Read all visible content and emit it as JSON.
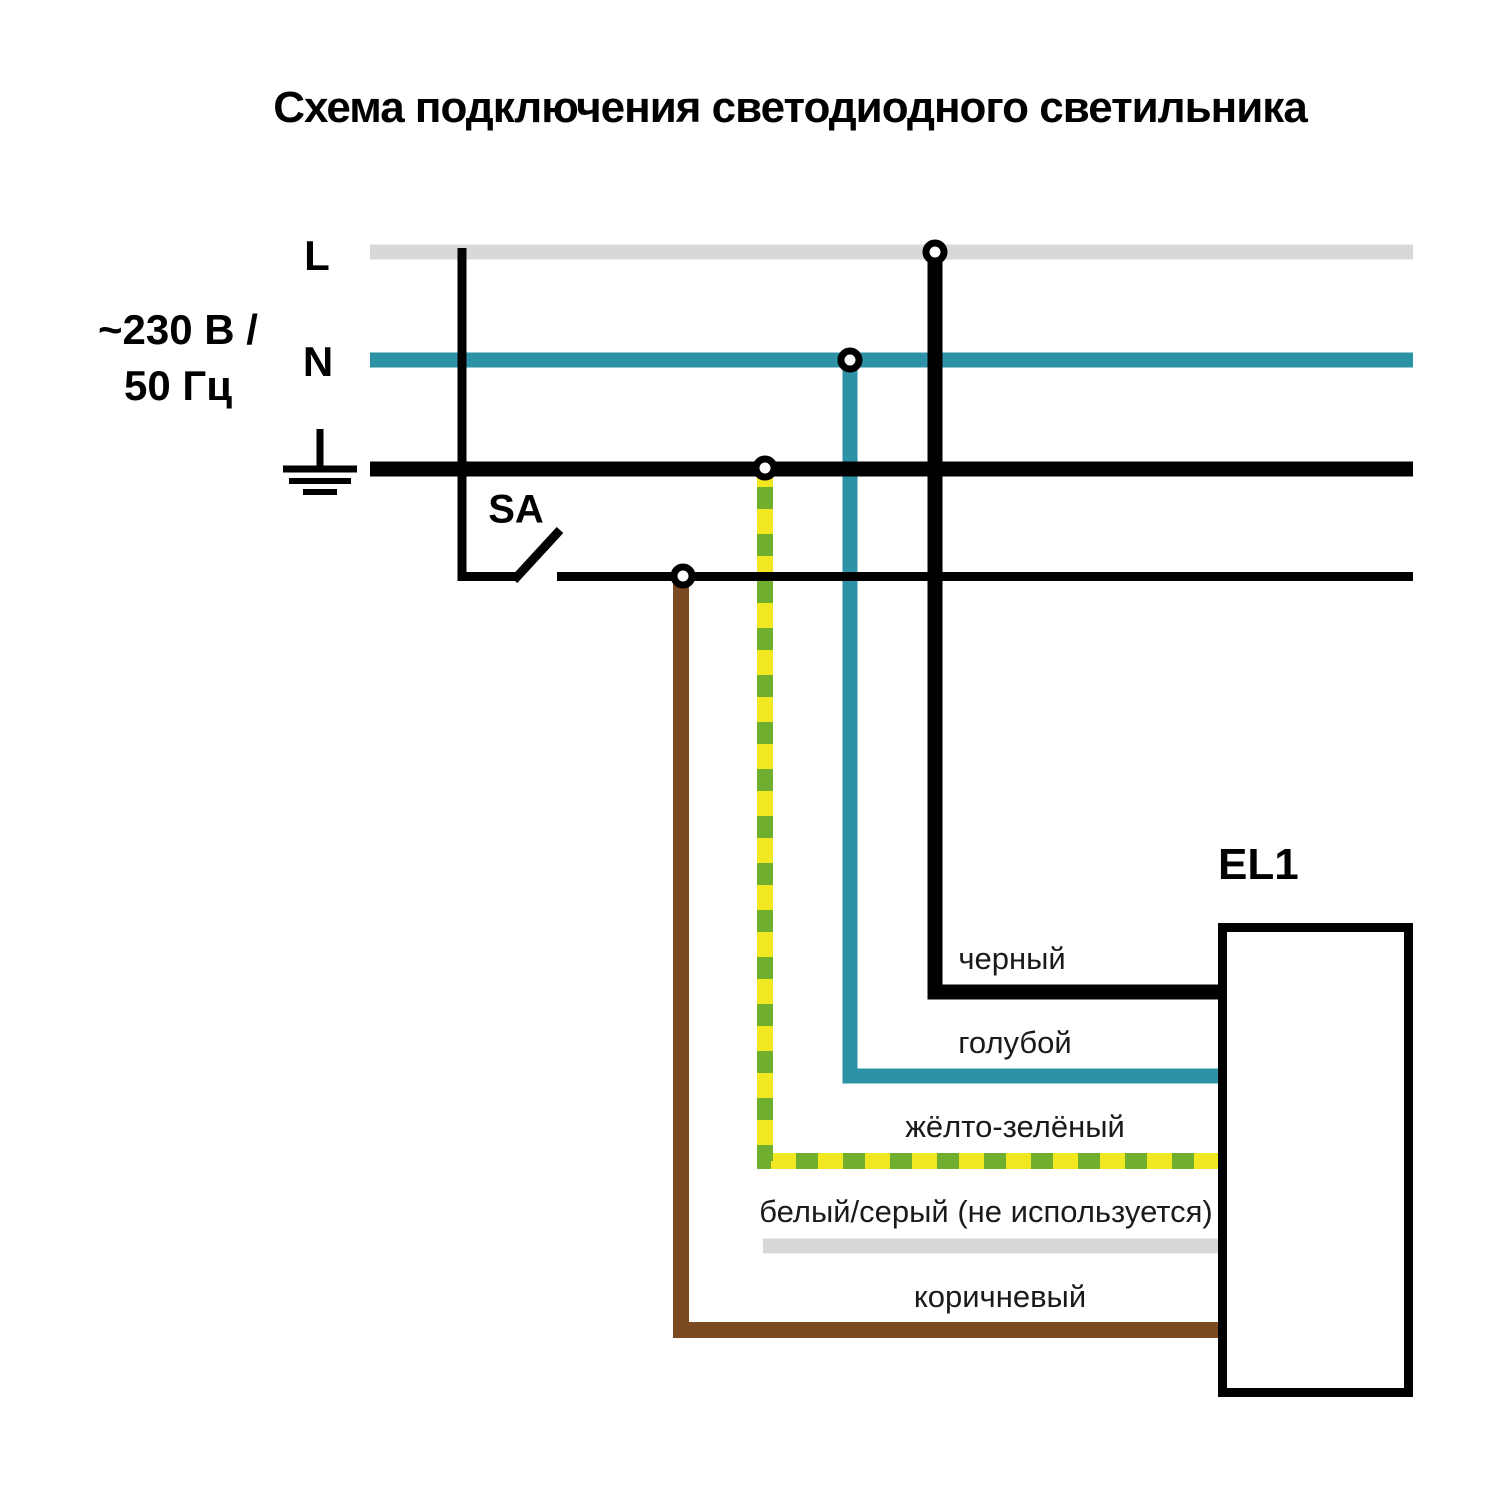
{
  "title": "Схема подключения светодиодного светильника",
  "power_source": {
    "phase_label": "L",
    "neutral_label": "N",
    "voltage_line1": "~230 В /",
    "voltage_line2": "50 Гц",
    "ground_icon": "earth-ground-symbol"
  },
  "switch": {
    "designator": "SA"
  },
  "luminaire": {
    "designator": "EL1"
  },
  "wires": {
    "black": {
      "label": "черный"
    },
    "blue": {
      "label": "голубой"
    },
    "yellow_green": {
      "label": "жёлто-зелёный"
    },
    "white_gray": {
      "label": "белый/серый (не используется)"
    },
    "brown": {
      "label": "коричневый"
    }
  },
  "colors": {
    "black": "#000000",
    "gray": "#d8d8d8",
    "teal": "#2e92a7",
    "yellow": "#f2e822",
    "green": "#6fae2f",
    "brown": "#7c4a21",
    "white": "#ffffff",
    "label_text": "#1a1a1a"
  }
}
